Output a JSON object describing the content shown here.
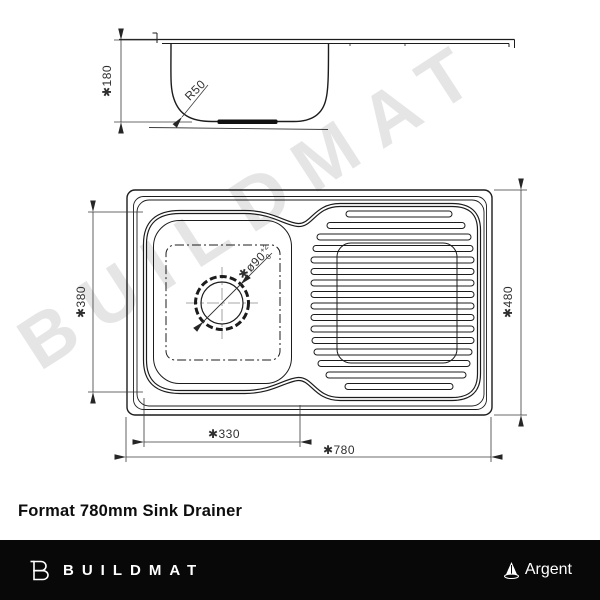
{
  "title": "Format 780mm Sink Drainer",
  "watermark": "BUILDMAT",
  "drawing": {
    "side_view": {
      "depth_dim": "✱180",
      "radius_label": "R50"
    },
    "plan_view": {
      "bowl_length_dim": "✱380",
      "bowl_width_dim": "✱330",
      "overall_width_dim": "✱780",
      "overall_depth_dim": "✱480",
      "drain_dim": {
        "prefix": "✱ø90",
        "tol_upper": "+2",
        "tol_lower": "0"
      }
    }
  },
  "footer": {
    "brand": "BUILDMAT",
    "partner": "Argent",
    "bar_color": "#080808"
  },
  "colors": {
    "line": "#1c1c1c",
    "dim_line": "#3a3a3a",
    "watermark": "#e5e5e5"
  }
}
